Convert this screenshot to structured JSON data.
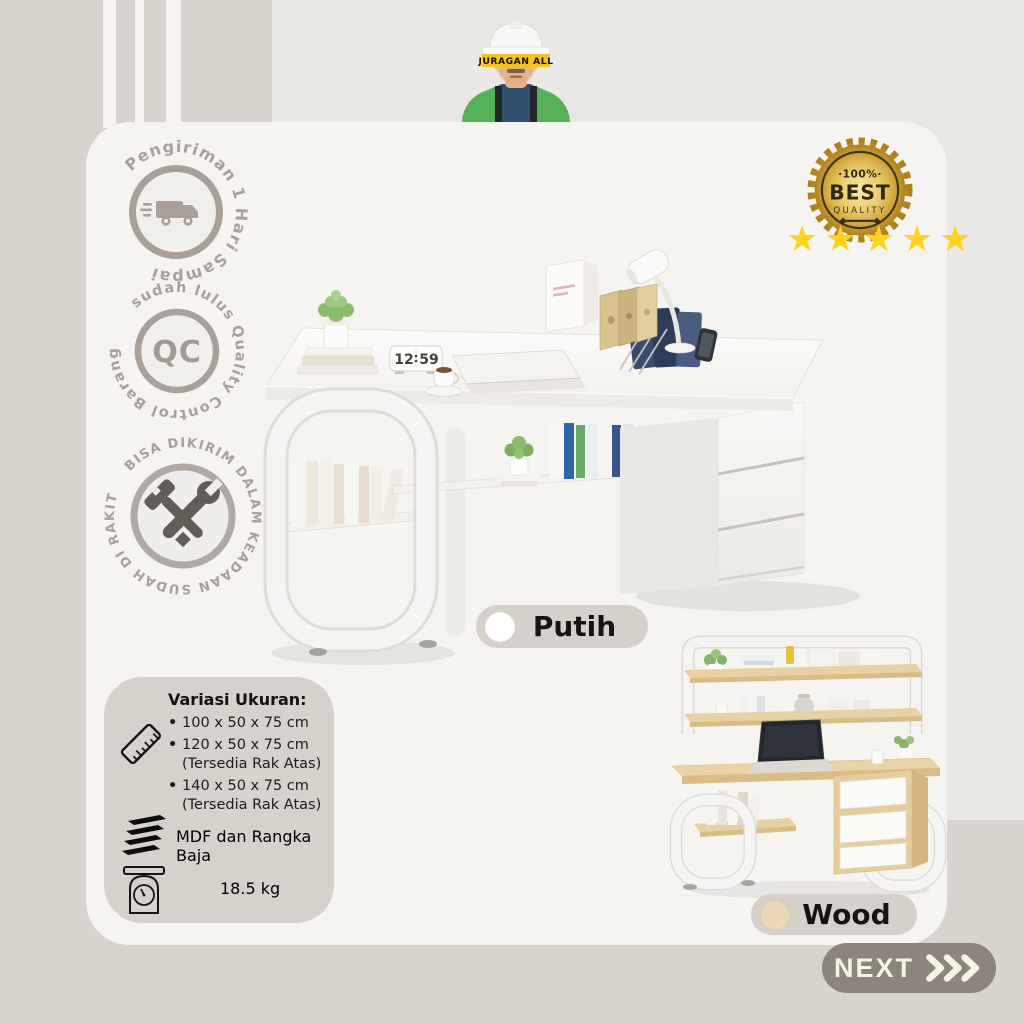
{
  "brand": {
    "name": "JURAGAN ALL"
  },
  "badges": {
    "shipping": {
      "circular_text": "Pengiriman 1 Hari Sampai",
      "icon": "delivery-truck"
    },
    "quality_control": {
      "circular_text": "sudah lulus Quality Control Barang",
      "center_label": "QC"
    },
    "assembled": {
      "circular_text": "BISA DIKIRIM DALAM KEADAAN SUDAH DI RAKIT",
      "icon": "hammer-wrench"
    }
  },
  "quality_seal": {
    "line1": "·100%·",
    "line2": "BEST",
    "line3": "QUALITY"
  },
  "rating": {
    "count": 5,
    "star_glyph": "★"
  },
  "product": {
    "variant_white": {
      "label": "Putih",
      "swatch_color": "#ffffff"
    },
    "variant_wood": {
      "label": "Wood",
      "swatch_color": "#ebd8b4"
    },
    "clock_left": "12",
    "clock_right": "59"
  },
  "specs": {
    "sizes_title": "Variasi Ukuran:",
    "sizes_icon": "ruler",
    "sizes": [
      {
        "size": "100 x 50 x 75 cm",
        "note": ""
      },
      {
        "size": "120 x 50 x 75 cm",
        "note": "(Tersedia Rak Atas)"
      },
      {
        "size": "140 x 50 x 75 cm",
        "note": "(Tersedia Rak Atas)"
      }
    ],
    "material": "MDF dan Rangka Baja",
    "material_icon": "mdf-layers",
    "weight": "18.5 kg",
    "weight_icon": "weighing-scale"
  },
  "cta": {
    "label": "NEXT",
    "icon": "triple-chevron-right"
  },
  "colors": {
    "background_left": "#d9d3ce",
    "background_right": "#eae8e5",
    "card": "#f5f4f1",
    "pill": "#d6d0ca",
    "badge_gray": "#a9a197",
    "next_button": "#8c857b",
    "star_yellow": "#ffd21f",
    "seal_gold": "#d9b44a",
    "wood": "#e7d0a1"
  }
}
